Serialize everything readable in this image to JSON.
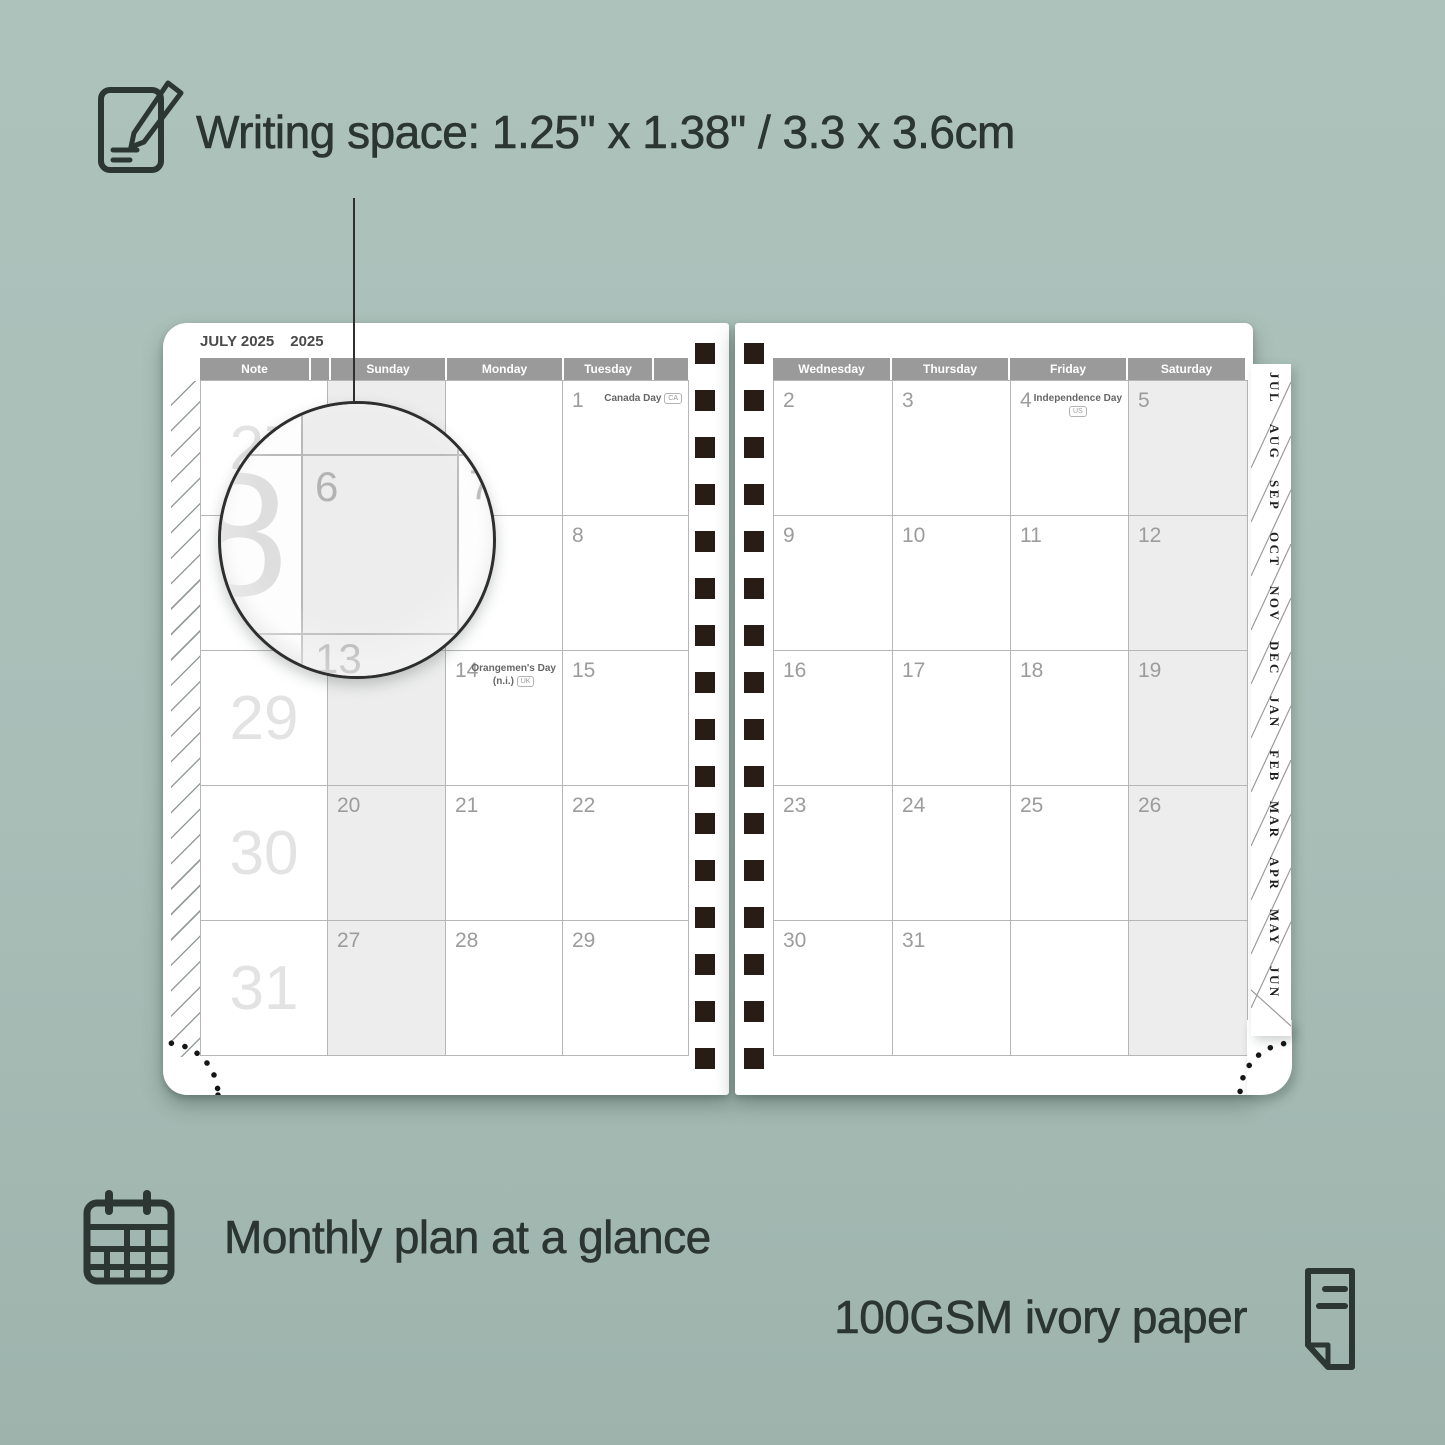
{
  "heading": {
    "label": "Writing space: 1.25\" x 1.38\" / 3.3 x 3.6cm"
  },
  "planner": {
    "month_title": "JULY 2025",
    "year_label": "2025",
    "left_page": {
      "columns": [
        "Note",
        "Sunday",
        "Monday",
        "Tuesday"
      ],
      "week_numbers": [
        "27",
        "28",
        "29",
        "30",
        "31"
      ],
      "rows": [
        [
          {
            "d": ""
          },
          {
            "d": ""
          },
          {
            "d": "1",
            "h1": "Canada Day",
            "b": "CA",
            "inline": true
          }
        ],
        [
          {
            "d": "6"
          },
          {
            "d": "7"
          },
          {
            "d": "8"
          }
        ],
        [
          {
            "d": "13"
          },
          {
            "d": "14",
            "h1": "Orangemen's Day",
            "h2": "(n.i.)",
            "b": "UK"
          },
          {
            "d": "15"
          }
        ],
        [
          {
            "d": "20"
          },
          {
            "d": "21"
          },
          {
            "d": "22"
          }
        ],
        [
          {
            "d": "27"
          },
          {
            "d": "28"
          },
          {
            "d": "29"
          }
        ]
      ]
    },
    "right_page": {
      "columns": [
        "Wednesday",
        "Thursday",
        "Friday",
        "Saturday"
      ],
      "rows": [
        [
          {
            "d": "2"
          },
          {
            "d": "3"
          },
          {
            "d": "4",
            "h1": "Independence Day",
            "b": "US"
          },
          {
            "d": "5"
          }
        ],
        [
          {
            "d": "9"
          },
          {
            "d": "10"
          },
          {
            "d": "11"
          },
          {
            "d": "12"
          }
        ],
        [
          {
            "d": "16"
          },
          {
            "d": "17"
          },
          {
            "d": "18"
          },
          {
            "d": "19"
          }
        ],
        [
          {
            "d": "23"
          },
          {
            "d": "24"
          },
          {
            "d": "25"
          },
          {
            "d": "26"
          }
        ],
        [
          {
            "d": "30"
          },
          {
            "d": "31"
          },
          {
            "d": ""
          },
          {
            "d": ""
          }
        ]
      ]
    },
    "tabs": [
      "JUL",
      "AUG",
      "SEP",
      "OCT",
      "NOV",
      "DEC",
      "JAN",
      "FEB",
      "MAR",
      "APR",
      "MAY",
      "JUN"
    ]
  },
  "magnifier": {
    "week_number_fragment": "8",
    "date_top_left": "6",
    "date_right": "7",
    "date_bottom": "13"
  },
  "features": [
    {
      "icon": "calendar-grid-icon",
      "label": "Monthly plan at a glance"
    },
    {
      "icon": "paper-icon",
      "label": "100GSM ivory paper"
    }
  ],
  "colors": {
    "background": "#a8beb7",
    "page": "#ffffff",
    "header_bar": "#9a9a9a",
    "weekend_shade": "#ededed",
    "binding_holes": "#281c16",
    "ink": "#2b3531"
  }
}
